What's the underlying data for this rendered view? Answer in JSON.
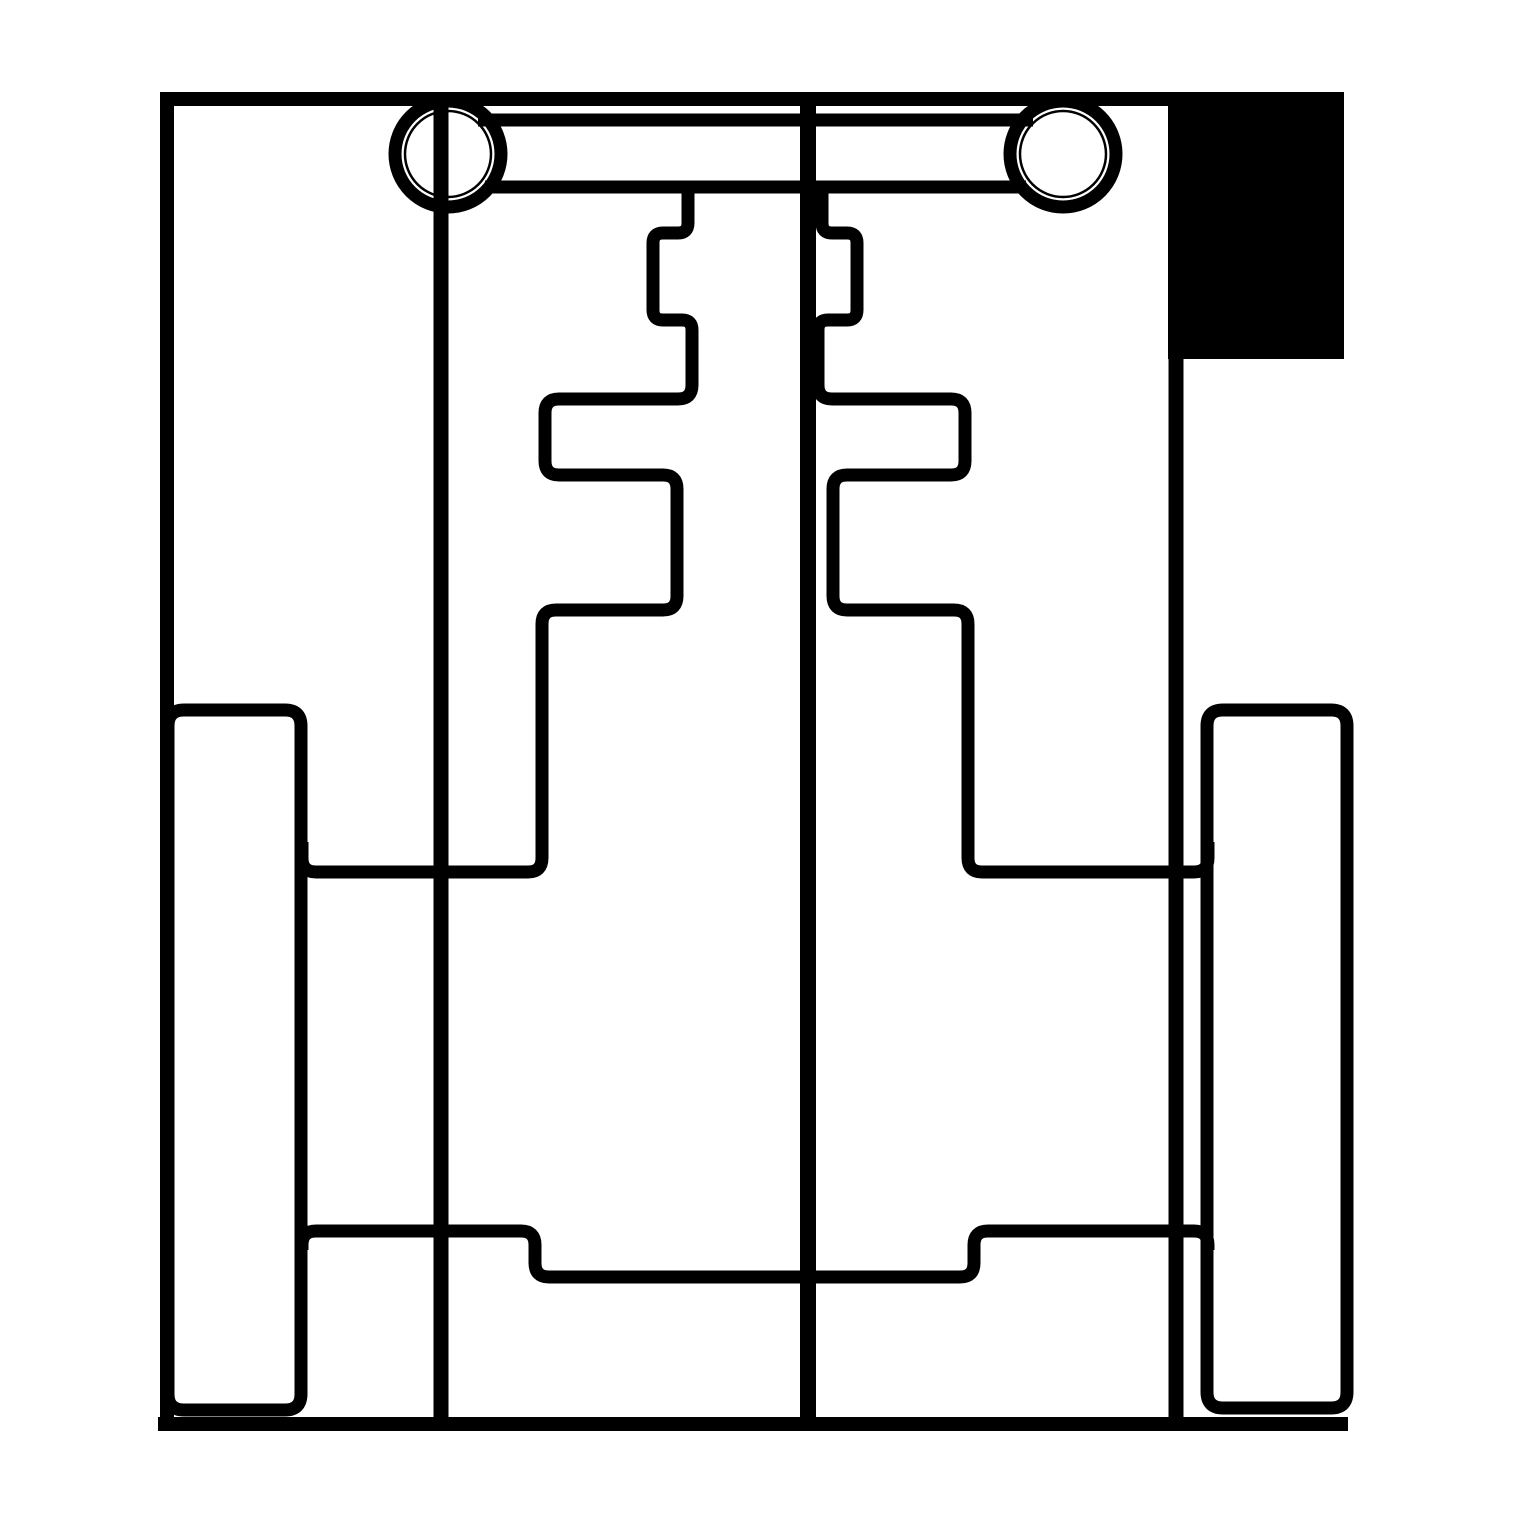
{
  "meta": {
    "description": "Monochrome technical line drawing (plan view of a mechanical chassis assembly): outer frame, two ringed hubs joined by an axle bar, stepped bracket profiles, side wheel outlines, bottom cross members, and a solid black block at top right.",
    "background_color": "#ffffff",
    "line_color": "#000000",
    "canvas_width": 1519,
    "canvas_height": 1519
  },
  "drawing": {
    "elements": [
      {
        "name": "solid-black-block",
        "type": "rect",
        "x": 1168,
        "y": 92,
        "width": 176,
        "height": 267,
        "fill": "#000000"
      },
      {
        "name": "outer-frame-left-top-edge",
        "type": "path",
        "d": "M 167,1431 L 167,99 L 1180,99",
        "stroke_width": 14
      },
      {
        "name": "outer-frame-right-edge",
        "type": "path",
        "d": "M 1176,95 L 1176,1424",
        "stroke_width": 15
      },
      {
        "name": "outer-frame-bottom-edge",
        "type": "path",
        "d": "M 158,1424 L 1348,1424",
        "stroke_width": 14
      },
      {
        "name": "center-divider-line",
        "type": "path",
        "d": "M 808,99 L 808,1424",
        "stroke_width": 16
      },
      {
        "name": "axle-bar-top-line",
        "type": "path",
        "d": "M 478,120 L 1033,120",
        "stroke_width": 13
      },
      {
        "name": "axle-bar-bottom-line",
        "type": "path",
        "d": "M 485,187 L 1026,187",
        "stroke_width": 13
      },
      {
        "name": "left-wheel-outline",
        "type": "path",
        "d": "M 168,726 Q 168,710 184,710 L 285,710 Q 301,710 301,726 L 301,1394 Q 301,1410 285,1410 L 184,1410 Q 168,1410 168,1394 Z",
        "stroke_width": 13
      },
      {
        "name": "right-wheel-outline",
        "type": "path",
        "d": "M 1207,726 Q 1207,710 1223,710 L 1331,710 Q 1347,710 1347,726 L 1347,1392 Q 1347,1408 1331,1408 L 1223,1408 Q 1207,1408 1207,1392 Z",
        "stroke_width": 13
      },
      {
        "name": "left-stepped-bracket",
        "type": "path",
        "d": "M 688,187 L 688,223 Q 688,233 678,233 L 663,233 Q 653,233 653,243 L 653,310 Q 653,320 663,320 L 682,320 Q 692,320 692,330 L 692,385 Q 692,399 678,399 L 559,399 Q 545,399 545,413 L 545,461 Q 545,475 559,475 L 663,475 Q 677,475 677,489 L 677,596 Q 677,610 663,610 L 556,610 Q 542,610 542,624 L 542,858 Q 542,872 528,872 L 316,872 Q 302,872 302,858 L 302,842",
        "stroke_width": 13
      },
      {
        "name": "right-stepped-bracket",
        "type": "path",
        "d": "M 822,187 L 822,223 Q 822,233 832,233 L 847,233 Q 857,233 857,243 L 857,310 Q 857,320 847,320 L 828,320 Q 818,320 818,330 L 818,385 Q 818,399 832,399 L 951,399 Q 965,399 965,413 L 965,461 Q 965,475 951,475 L 847,475 Q 833,475 833,489 L 833,596 Q 833,610 847,610 L 954,610 Q 968,610 968,624 L 968,858 Q 968,872 982,872 L 1194,872 Q 1208,872 1208,858 L 1208,842",
        "stroke_width": 13
      },
      {
        "name": "bottom-cross-member",
        "type": "path",
        "d": "M 302,1250 L 302,1245 Q 302,1231 316,1231 L 521,1231 Q 535,1231 535,1245 L 535,1263 Q 535,1277 549,1277 L 960,1277 Q 974,1277 974,1263 L 974,1245 Q 974,1231 988,1231 L 1194,1231 Q 1208,1231 1208,1245 L 1208,1250",
        "stroke_width": 13
      },
      {
        "name": "left-hub-axle-line",
        "type": "path",
        "d": "M 441,96 L 441,1424",
        "stroke_width": 15
      },
      {
        "name": "left-hub-ring",
        "type": "circle",
        "cx": 448,
        "cy": 154,
        "r": 53,
        "stroke_width": 13
      },
      {
        "name": "left-hub-inner-circle",
        "type": "circle",
        "cx": 448,
        "cy": 154,
        "r": 43,
        "stroke_width": 2.5
      },
      {
        "name": "right-hub-ring",
        "type": "circle",
        "cx": 1063,
        "cy": 154,
        "r": 53,
        "stroke_width": 13
      },
      {
        "name": "right-hub-inner-circle",
        "type": "circle",
        "cx": 1063,
        "cy": 154,
        "r": 43,
        "stroke_width": 2.5
      }
    ]
  }
}
